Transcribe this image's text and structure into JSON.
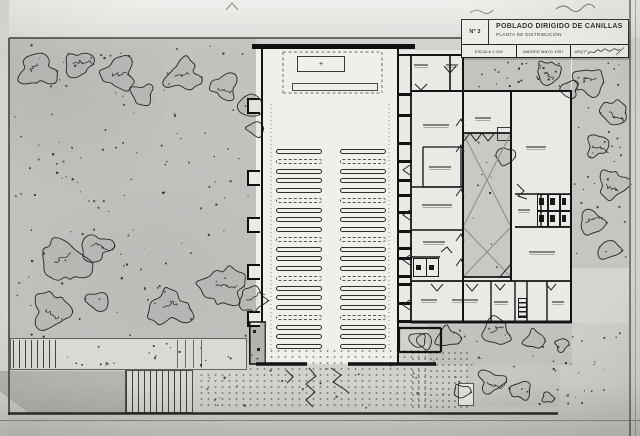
{
  "title_block": {
    "sheet_no": "Nº 3",
    "project_title": "POBLADO DIRIGIDO DE CANILLAS",
    "drawing_title": "PLANTA DE DISTRIBUCIÓN",
    "scale_label": "ESCALA 1:100",
    "place_date_label": "MADRID MAYO 1957",
    "architect_label": "ARQTº"
  },
  "plan": {
    "church": {
      "pew_rows": 21,
      "pew_columns": 2,
      "altar_cross_glyph": "+"
    },
    "courtyard_x_cells": 2,
    "trees": [
      [
        38,
        70,
        20
      ],
      [
        78,
        64,
        16
      ],
      [
        118,
        74,
        18
      ],
      [
        142,
        94,
        13
      ],
      [
        182,
        76,
        19
      ],
      [
        224,
        88,
        16
      ],
      [
        251,
        105,
        13
      ],
      [
        256,
        128,
        10
      ],
      [
        64,
        262,
        26
      ],
      [
        96,
        246,
        17
      ],
      [
        52,
        310,
        20
      ],
      [
        98,
        300,
        13
      ],
      [
        170,
        308,
        22
      ],
      [
        224,
        286,
        24
      ],
      [
        252,
        300,
        15
      ],
      [
        549,
        72,
        15
      ],
      [
        570,
        90,
        10
      ],
      [
        588,
        82,
        16
      ],
      [
        614,
        112,
        15
      ],
      [
        598,
        146,
        14
      ],
      [
        612,
        184,
        16
      ],
      [
        592,
        222,
        14
      ],
      [
        610,
        250,
        12
      ],
      [
        447,
        337,
        13
      ],
      [
        425,
        341,
        9
      ],
      [
        496,
        332,
        16
      ],
      [
        534,
        340,
        12
      ],
      [
        562,
        345,
        8
      ],
      [
        492,
        382,
        15
      ],
      [
        520,
        390,
        12
      ],
      [
        461,
        392,
        9
      ],
      [
        547,
        398,
        7
      ],
      [
        506,
        156,
        11
      ],
      [
        418,
        340,
        10
      ]
    ],
    "dot_regions": [
      [
        14,
        44,
        236,
        294,
        130
      ],
      [
        574,
        42,
        52,
        220,
        40
      ],
      [
        465,
        60,
        102,
        26,
        22
      ],
      [
        430,
        326,
        196,
        80,
        45
      ],
      [
        205,
        352,
        220,
        55,
        28
      ],
      [
        62,
        342,
        140,
        24,
        18
      ],
      [
        468,
        140,
        40,
        130,
        10
      ]
    ]
  },
  "colors": {
    "photo_base": "#d2d1ce",
    "garden": "#c3c2bf",
    "paper": "#f0efeb",
    "complex_paper": "#eae9e5",
    "courtyard": "#c9c8c5",
    "ink": "#141414"
  }
}
